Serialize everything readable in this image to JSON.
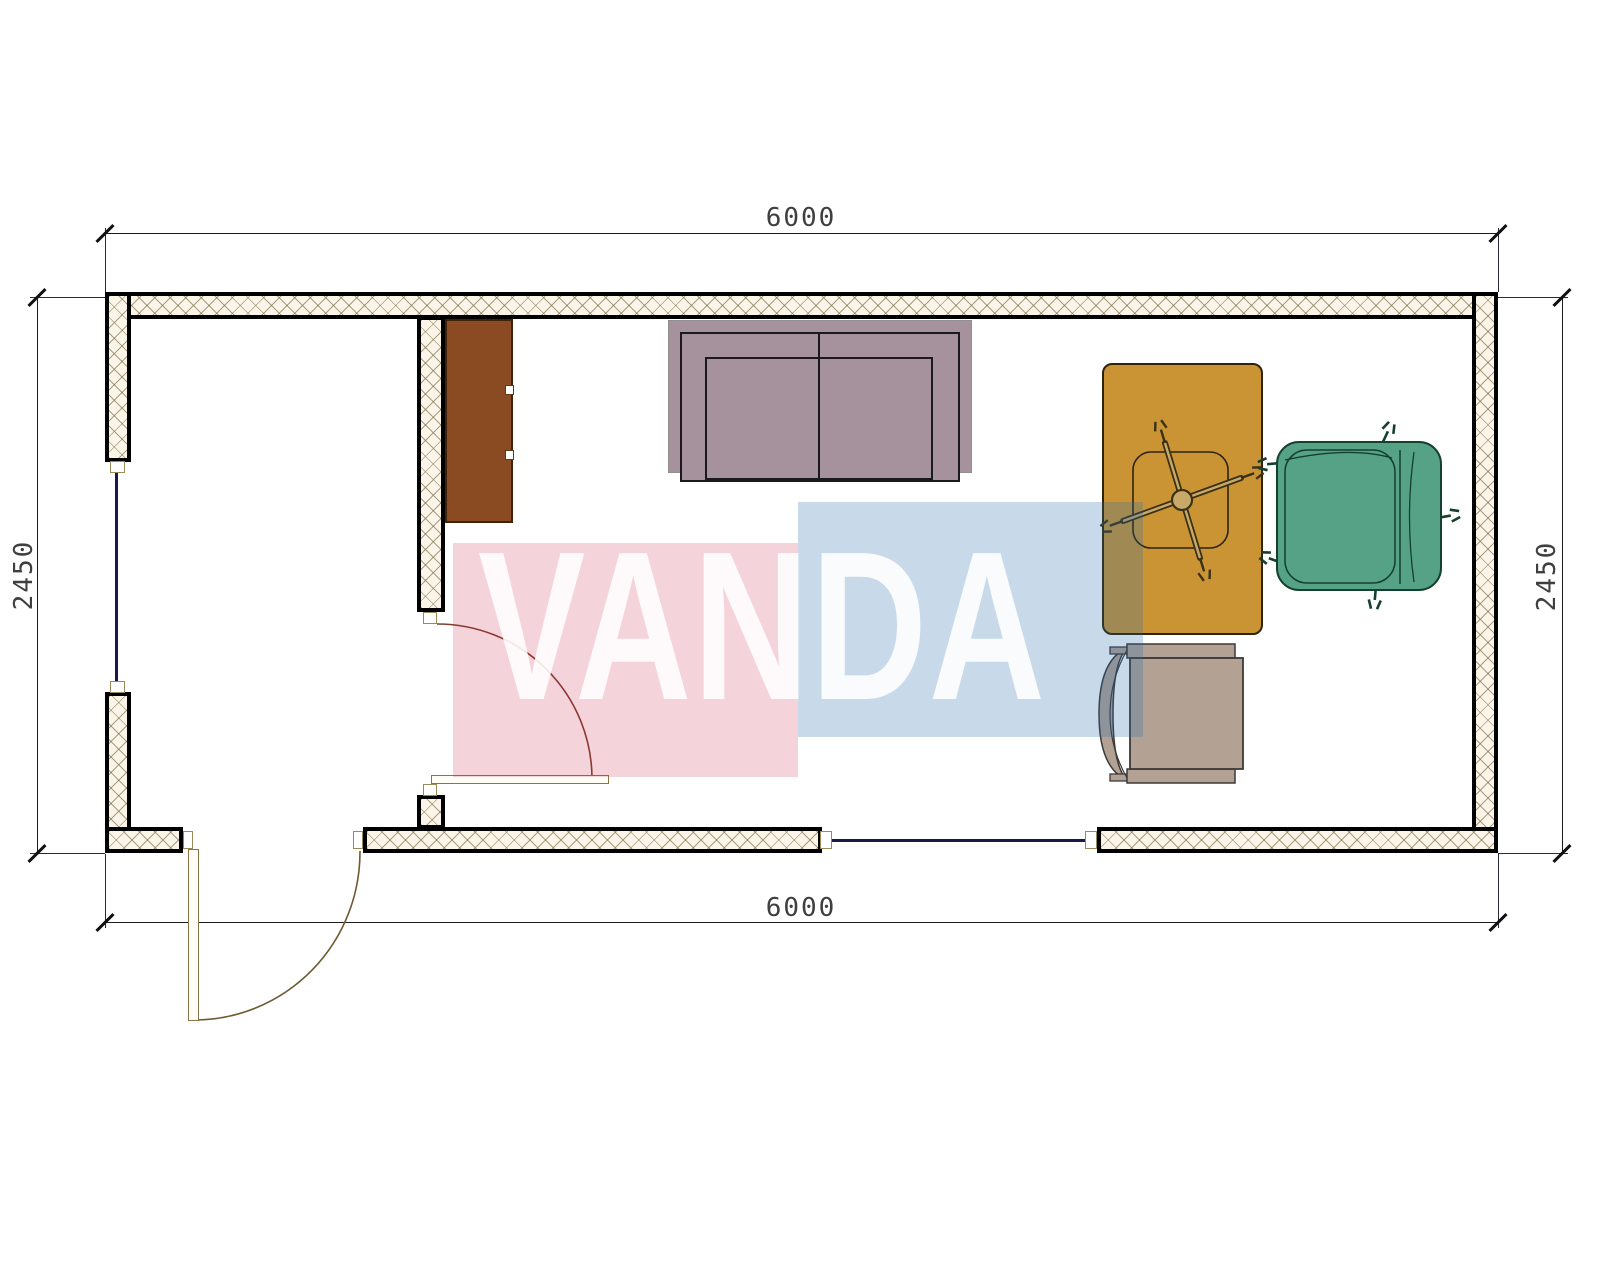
{
  "drawing": {
    "title": "floor-plan",
    "dimensions": {
      "top": {
        "label": "6000"
      },
      "bottom": {
        "label": "6000"
      },
      "left": {
        "label": "2450"
      },
      "right": {
        "label": "2450"
      }
    },
    "watermark": {
      "text": "VANDA"
    },
    "furniture": [
      "cabinet",
      "sofa",
      "desk",
      "office-chair",
      "armchair",
      "side-chair"
    ]
  },
  "colors": {
    "cabinet": "#8a4a22",
    "sofa": "#a6929d",
    "desk": "#ca9434",
    "chair_green": "#55a287",
    "chair_beige": "#b3a294",
    "wall_fill": "#faf5e8",
    "wm_pink": "rgba(204,34,68,0.20)",
    "wm_blue": "rgba(34,102,170,0.25)",
    "wm_letters": "rgba(255,255,255,0.88)"
  }
}
